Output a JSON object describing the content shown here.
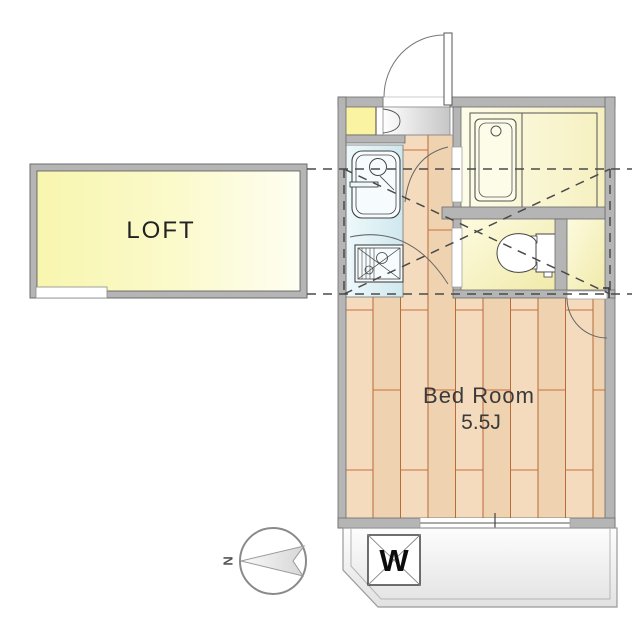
{
  "document": "apartment-floor-plan",
  "labels": {
    "loft": "LOFT",
    "bedroom": "Bed Room",
    "bedroom_size": "5.5J",
    "washer": "W",
    "compass_north": "N"
  },
  "rooms": {
    "loft": {
      "label": "LOFT"
    },
    "bedroom": {
      "label": "Bed Room",
      "size_tatami": "5.5J"
    }
  },
  "fixtures": [
    "entry-door-icon",
    "kitchen-sink-icon",
    "gas-stove-icon",
    "bathtub-icon",
    "toilet-icon",
    "washing-machine-icon",
    "north-compass-icon",
    "loft-projection-dashed-outline",
    "door-swing-arcs",
    "balcony",
    "window"
  ],
  "colors": {
    "wall": "#b5b5b5",
    "wall_edge": "#6b6b6b",
    "loft_fill": "#f9f8b6",
    "wood_floor": "#f4dbbd",
    "plank_line": "#c06a38",
    "kitchen_fill": "#ddeff4",
    "bath_fill": "#faf7d0",
    "shoe_cabinet_fill": "#faf3a2",
    "balcony_fill": "#ececec",
    "dashed_line": "#4a4a4a"
  }
}
